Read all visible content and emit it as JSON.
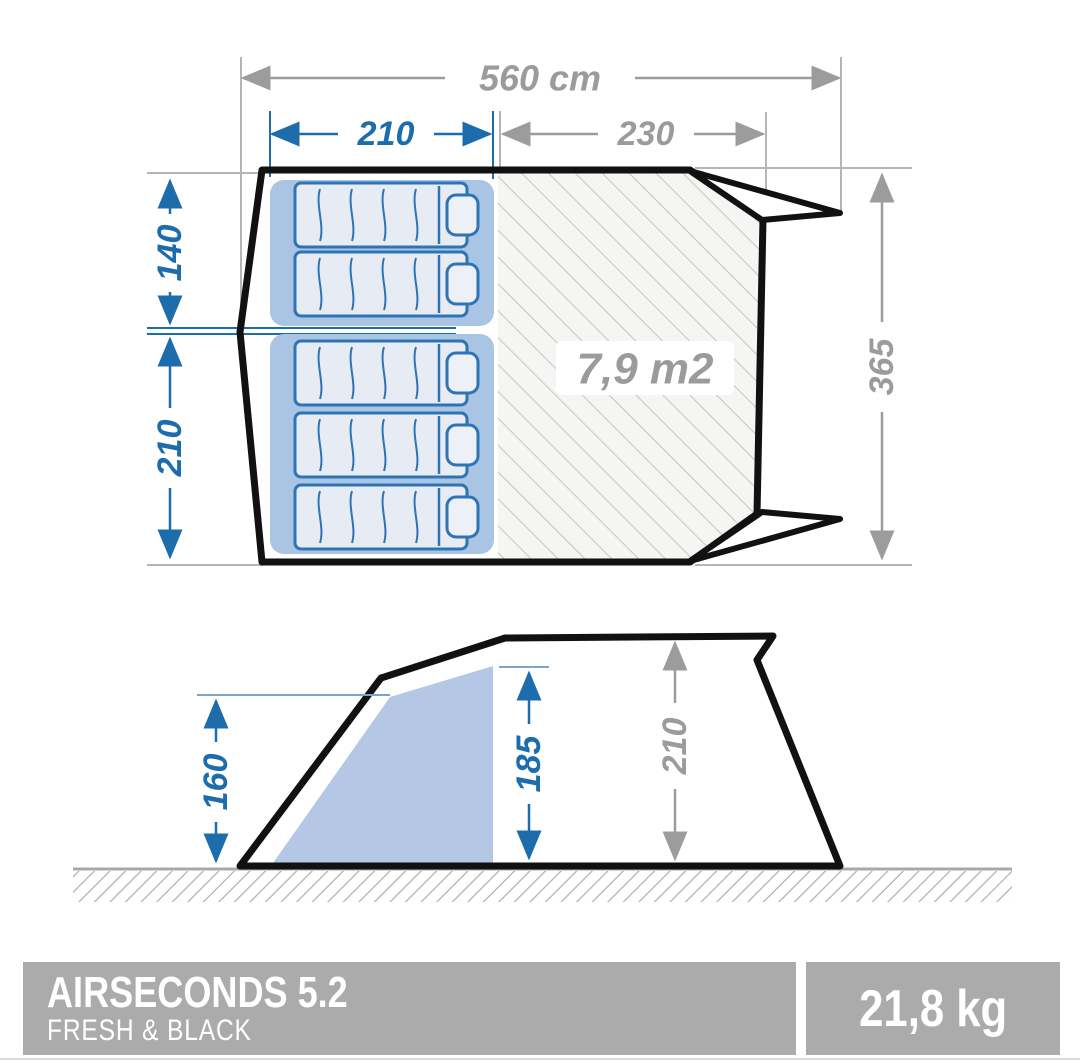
{
  "top_view": {
    "total_width": "560 cm",
    "bedroom_width": "210",
    "living_width": "230",
    "bedroom_top_depth": "140",
    "bedroom_bottom_depth": "210",
    "total_depth": "365",
    "living_area": "7,9 m2"
  },
  "side_view": {
    "awning_height": "160",
    "cabin_height": "185",
    "max_height": "210"
  },
  "footer": {
    "title": "AIRSECONDS 5.2",
    "subtitle": "FRESH & BLACK",
    "weight": "21,8 kg"
  },
  "colors": {
    "dimension_blue": "#1d6cab",
    "dimension_gray": "#9c9c9c",
    "extension_gray": "#b5b5b5",
    "bedroom_fill": "#aac4e4",
    "mattress_fill": "#e7ebf4",
    "mattress_stroke": "#2e74b4",
    "cabin_fill": "#b4c7e4",
    "hatch_line": "#c9cac8",
    "outline_black": "#111111",
    "footer_gray": "#ababab"
  }
}
